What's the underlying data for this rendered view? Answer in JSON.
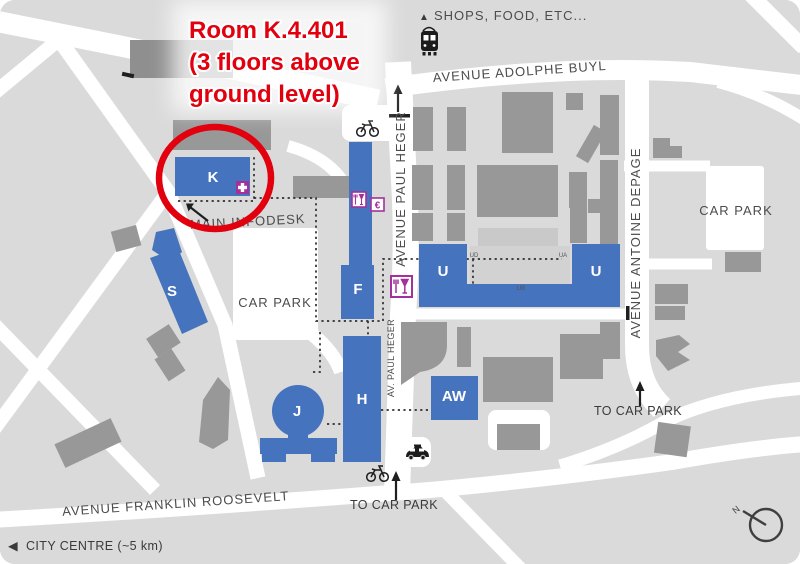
{
  "map": {
    "annotation": {
      "line1": "Room K.4.401",
      "line2": "(3 floors above",
      "line3": "ground level)"
    },
    "streets": {
      "adolphe_buyl": "AVENUE ADOLPHE BUYL",
      "paul_heger": "AVENUE PAUL HEGER",
      "paul_heger_short": "AV. PAUL HEGER",
      "antoine_depage": "AVENUE ANTOINE DEPAGE",
      "franklin_roosevelt": "AVENUE FRANKLIN ROOSEVELT"
    },
    "areas": {
      "car_park_center": "CAR PARK",
      "car_park_right": "CAR PARK"
    },
    "directions": {
      "shops_triangle": "▲",
      "shops": "SHOPS, FOOD, ETC...",
      "city_centre_arrow": "◀",
      "city_centre": "CITY CENTRE (~5 km)",
      "to_car_park_south": "TO CAR PARK",
      "to_car_park_east": "TO CAR PARK",
      "main_infodesk": "MAIN INFODESK",
      "north": "N"
    },
    "buildings": {
      "k": "K",
      "s": "S",
      "f": "F",
      "u_west": "U",
      "u_east": "U",
      "h": "H",
      "j": "J",
      "aw": "AW",
      "ud_label": "UD",
      "ua_label": "UA",
      "ub_label": "UB"
    },
    "poi": {
      "euro": "€"
    },
    "colors": {
      "map_bg": "#dadada",
      "road_white": "#ffffff",
      "building_gray": "#989898",
      "building_blue": "#4573bd",
      "annotation_red": "#e2000f",
      "poi_magenta": "#a4309c",
      "label_gray": "#4c4c4c"
    }
  }
}
